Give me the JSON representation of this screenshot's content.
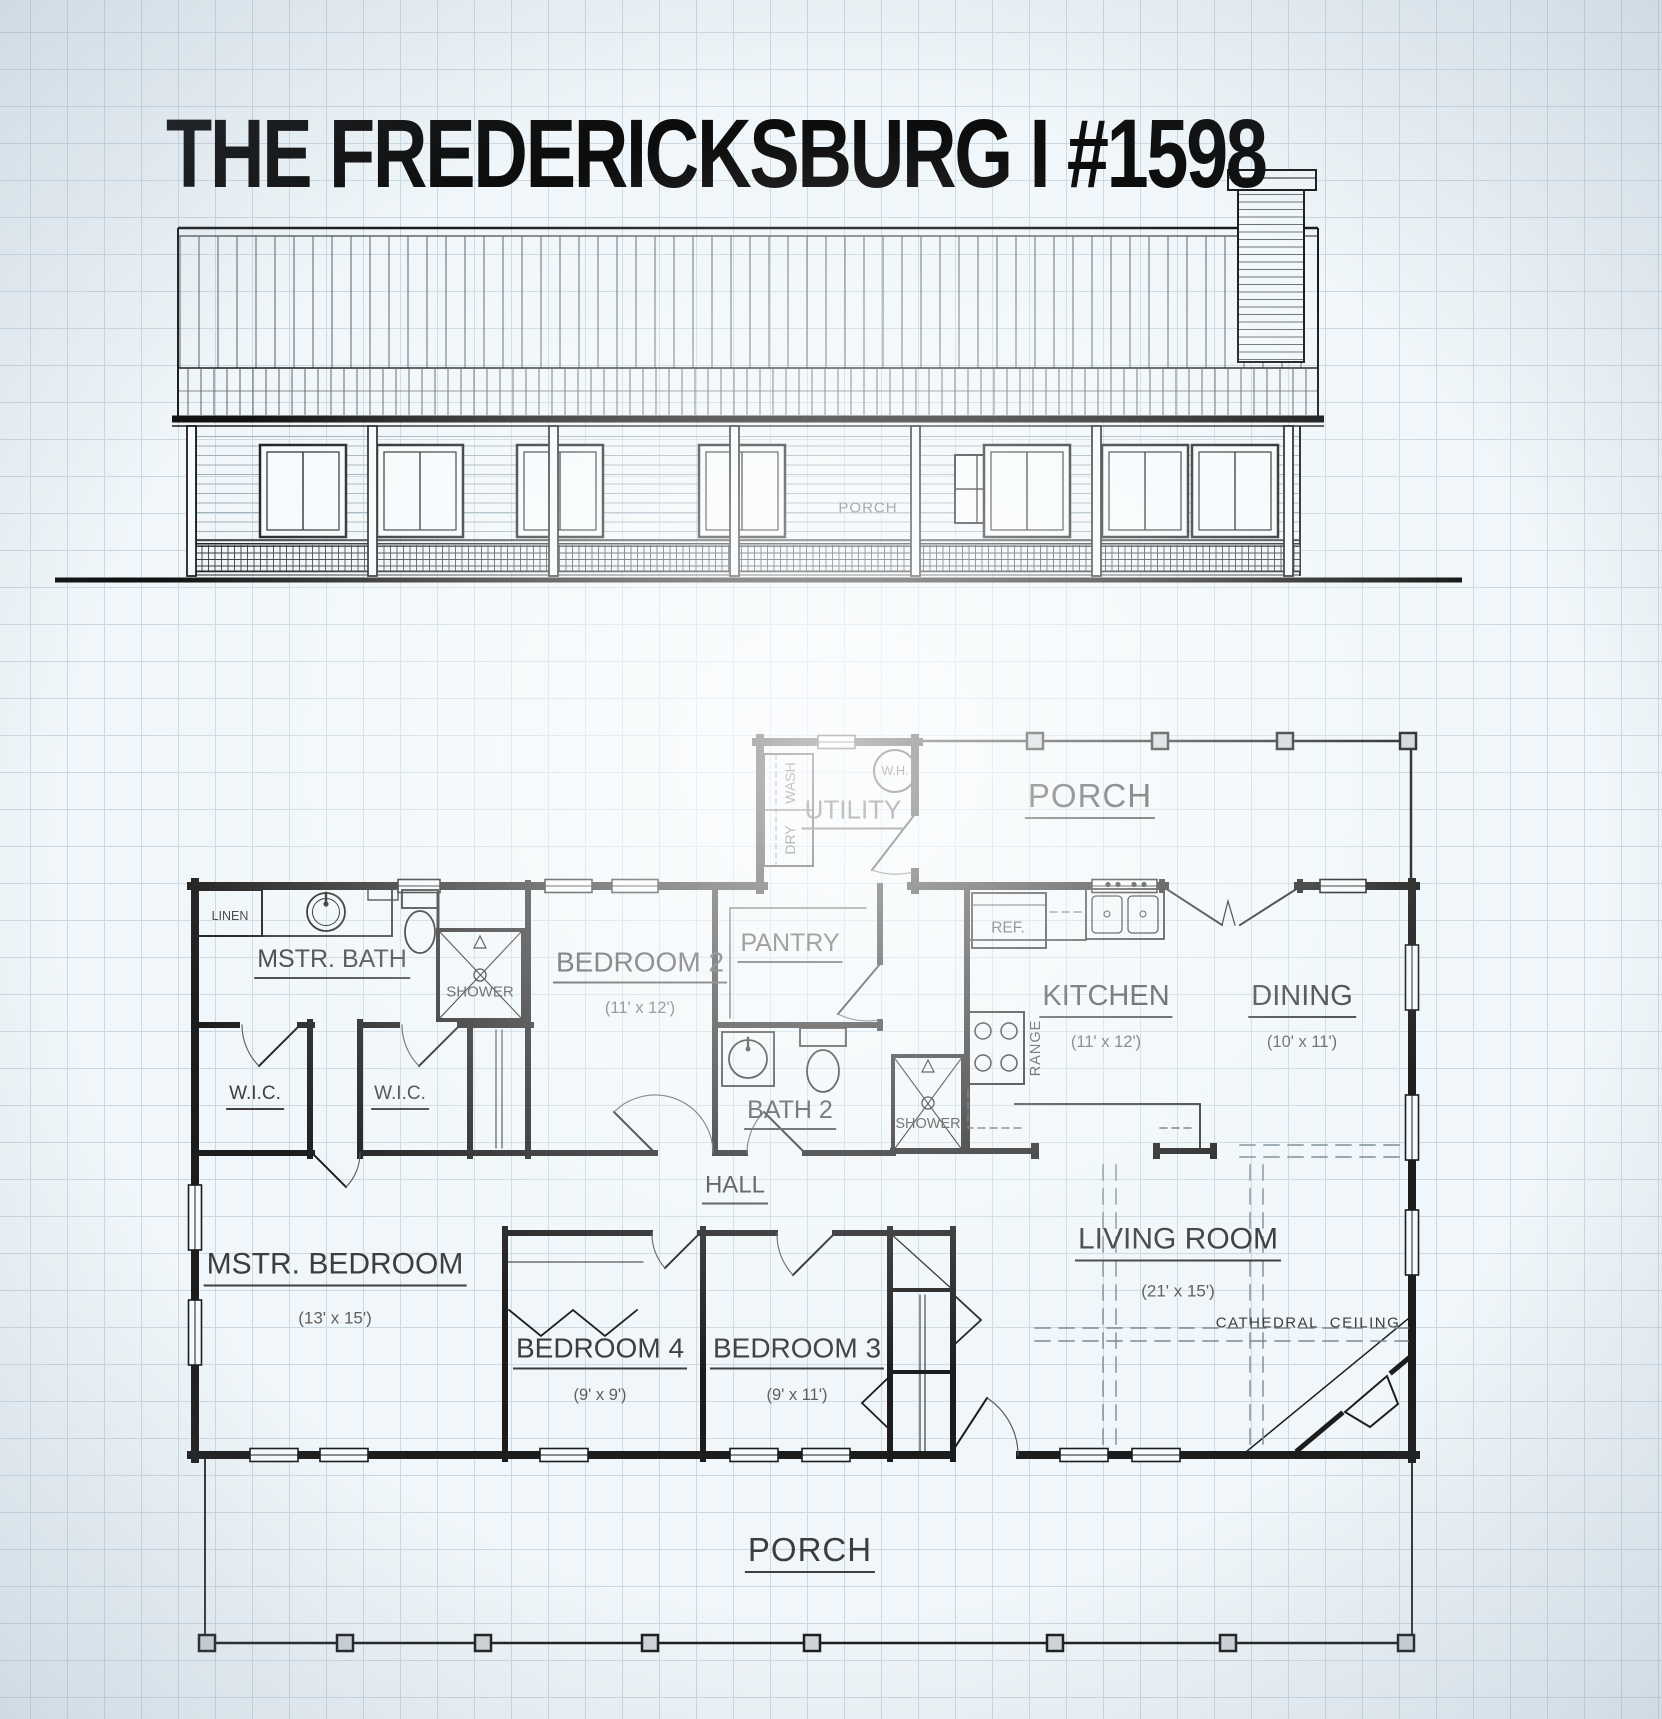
{
  "title": "THE FREDERICKSBURG I #1598",
  "elevation": {
    "porch_label": "PORCH"
  },
  "plan": {
    "rooms": {
      "utility": {
        "label": "UTILITY"
      },
      "mstr_bath": {
        "label": "MSTR. BATH"
      },
      "bedroom2": {
        "label": "BEDROOM 2",
        "dims": "(11' x 12')"
      },
      "pantry": {
        "label": "PANTRY"
      },
      "kitchen": {
        "label": "KITCHEN",
        "dims": "(11' x 12')"
      },
      "dining": {
        "label": "DINING",
        "dims": "(10' x 11')"
      },
      "bath2": {
        "label": "BATH 2"
      },
      "hall": {
        "label": "HALL"
      },
      "mstr_bedroom": {
        "label": "MSTR. BEDROOM",
        "dims": "(13' x 15')"
      },
      "bedroom4": {
        "label": "BEDROOM 4",
        "dims": "(9' x 9')"
      },
      "bedroom3": {
        "label": "BEDROOM 3",
        "dims": "(9' x 11')"
      },
      "living_room": {
        "label": "LIVING ROOM",
        "dims": "(21' x 15')"
      }
    },
    "closets": {
      "wic1": {
        "label": "W.I.C."
      },
      "wic2": {
        "label": "W.I.C."
      },
      "linen": {
        "label": "LINEN"
      }
    },
    "porches": {
      "top": {
        "label": "PORCH"
      },
      "bottom": {
        "label": "PORCH"
      }
    },
    "fixtures": {
      "washer": {
        "label": "WASH"
      },
      "dryer": {
        "label": "DRY"
      },
      "water_heater": {
        "label": "W.H."
      },
      "refrigerator": {
        "label": "REF."
      },
      "range": {
        "label": "RANGE"
      },
      "shower_mstr": {
        "label": "SHOWER"
      },
      "shower_bath2": {
        "label": "SHOWER"
      }
    },
    "annotations": {
      "cathedral_ceiling": {
        "label": "CATHEDRAL  CEILING"
      }
    }
  }
}
